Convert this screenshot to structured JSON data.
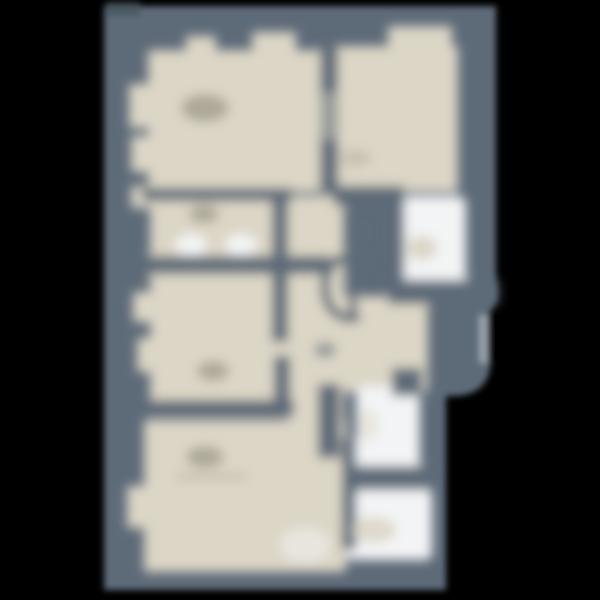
{
  "canvas": {
    "width": 600,
    "height": 600,
    "background": "#000000"
  },
  "palette": {
    "wall": "#5d6b78",
    "wall_dark": "#49565f",
    "floor": "#dcd6c6",
    "white": "#f3f4f5",
    "smudge": "#9d9889",
    "smudge_light": "#b5af9f",
    "edge_light": "#97a1ab",
    "background": "#000000"
  },
  "floorplan": {
    "description": "heavily blurred apartment floor plan, dark slate walls on black background with beige rooms and white bathroom areas",
    "layers": [
      {
        "name": "silhouette",
        "blur": 3.2,
        "shapes": [
          {
            "type": "path",
            "name": "plan-footprint",
            "fill": "wall",
            "d": "M104,6 L496,6 L496,302 L491,310 L491,358 Q491,396 452,396 L446,396 L446,590 L104,590 Z"
          },
          {
            "type": "rect",
            "name": "top-left-wall-shadow",
            "fill": "wall_dark",
            "x": 106,
            "y": 2,
            "w": 34,
            "h": 14,
            "opacity": 0.8
          },
          {
            "type": "rect",
            "name": "balcony-edge-highlight",
            "fill": "edge_light",
            "x": 479,
            "y": 315,
            "w": 9,
            "h": 48
          },
          {
            "type": "rect",
            "name": "balcony-edge-slit",
            "fill": "background",
            "x": 488,
            "y": 312,
            "w": 5,
            "h": 50
          }
        ]
      },
      {
        "name": "interior",
        "blur": 5.5,
        "shapes": [
          {
            "type": "rect",
            "name": "room-top-left-floor",
            "fill": "floor",
            "x": 148,
            "y": 50,
            "w": 174,
            "h": 142
          },
          {
            "type": "rect",
            "name": "window-notch-top-1",
            "fill": "floor",
            "x": 186,
            "y": 36,
            "w": 30,
            "h": 22
          },
          {
            "type": "rect",
            "name": "window-notch-top-2",
            "fill": "floor",
            "x": 252,
            "y": 32,
            "w": 44,
            "h": 26
          },
          {
            "type": "rect",
            "name": "window-notch-left-1",
            "fill": "floor",
            "x": 129,
            "y": 84,
            "w": 24,
            "h": 44
          },
          {
            "type": "rect",
            "name": "window-notch-left-2",
            "fill": "floor",
            "x": 131,
            "y": 136,
            "w": 22,
            "h": 36
          },
          {
            "type": "rect",
            "name": "room-left-2-floor",
            "fill": "floor",
            "x": 150,
            "y": 200,
            "w": 140,
            "h": 60
          },
          {
            "type": "rect",
            "name": "window-notch-left-3",
            "fill": "floor",
            "x": 131,
            "y": 186,
            "w": 20,
            "h": 22
          },
          {
            "type": "rect",
            "name": "room-left-3-floor",
            "fill": "floor",
            "x": 150,
            "y": 274,
            "w": 142,
            "h": 128
          },
          {
            "type": "rect",
            "name": "window-notch-left-4",
            "fill": "floor",
            "x": 133,
            "y": 292,
            "w": 18,
            "h": 30
          },
          {
            "type": "rect",
            "name": "window-notch-left-5",
            "fill": "floor",
            "x": 137,
            "y": 338,
            "w": 16,
            "h": 34
          },
          {
            "type": "rect",
            "name": "room-bottom-left-floor",
            "fill": "floor",
            "x": 144,
            "y": 420,
            "w": 202,
            "h": 152
          },
          {
            "type": "rect",
            "name": "window-notch-left-6",
            "fill": "floor",
            "x": 127,
            "y": 486,
            "w": 18,
            "h": 42
          },
          {
            "type": "rect",
            "name": "corridor-floor",
            "fill": "floor",
            "x": 288,
            "y": 196,
            "w": 56,
            "h": 368
          },
          {
            "type": "rect",
            "name": "room-top-right-floor",
            "fill": "floor",
            "x": 338,
            "y": 46,
            "w": 120,
            "h": 146
          },
          {
            "type": "rect",
            "name": "window-notch-top-right",
            "fill": "floor",
            "x": 388,
            "y": 26,
            "w": 64,
            "h": 24
          },
          {
            "type": "rect",
            "name": "hall-middle-floor",
            "fill": "floor",
            "x": 288,
            "y": 296,
            "w": 140,
            "h": 96
          },
          {
            "type": "rect",
            "name": "bathroom-1-floor",
            "fill": "white",
            "x": 402,
            "y": 196,
            "w": 64,
            "h": 92,
            "rx": 8
          },
          {
            "type": "ellipse",
            "name": "door-swing-1",
            "fill": "white",
            "cx": 191,
            "cy": 245,
            "rxr": 16,
            "ryr": 11
          },
          {
            "type": "ellipse",
            "name": "door-swing-2",
            "fill": "white",
            "cx": 241,
            "cy": 245,
            "rxr": 16,
            "ryr": 11
          },
          {
            "type": "rect",
            "name": "bathroom-2-floor",
            "fill": "white",
            "x": 356,
            "y": 386,
            "w": 64,
            "h": 88,
            "rx": 8
          },
          {
            "type": "rect",
            "name": "bathroom-3-floor",
            "fill": "white",
            "x": 346,
            "y": 488,
            "w": 86,
            "h": 72,
            "rx": 6
          },
          {
            "type": "ellipse",
            "name": "light-patch-room4",
            "fill": "white",
            "cx": 305,
            "cy": 545,
            "rxr": 26,
            "ryr": 18,
            "opacity": 0.5
          },
          {
            "type": "ellipse",
            "name": "light-patch-hall",
            "fill": "white",
            "cx": 445,
            "cy": 272,
            "rxr": 20,
            "ryr": 14,
            "opacity": 0.6
          },
          {
            "type": "rect",
            "name": "wall-room1-room2",
            "fill": "wall",
            "x": 142,
            "y": 188,
            "w": 150,
            "h": 13
          },
          {
            "type": "rect",
            "name": "wall-room2-room3",
            "fill": "wall",
            "x": 131,
            "y": 256,
            "w": 200,
            "h": 18
          },
          {
            "type": "rect",
            "name": "wall-room3-room4",
            "fill": "wall",
            "x": 150,
            "y": 400,
            "w": 144,
            "h": 16
          },
          {
            "type": "rect",
            "name": "wall-corridor-left-upper",
            "fill": "wall",
            "x": 272,
            "y": 194,
            "w": 16,
            "h": 148
          },
          {
            "type": "rect",
            "name": "wall-corridor-left-lower",
            "fill": "wall",
            "x": 274,
            "y": 356,
            "w": 16,
            "h": 60
          },
          {
            "type": "rect",
            "name": "wall-top-middle",
            "fill": "wall",
            "x": 320,
            "y": 44,
            "w": 18,
            "h": 152
          },
          {
            "type": "rect",
            "name": "door-gap-top-middle",
            "fill": "floor",
            "x": 320,
            "y": 92,
            "w": 18,
            "h": 48,
            "opacity": 0.45
          },
          {
            "type": "rect",
            "name": "wall-bathroom1-top",
            "fill": "wall",
            "x": 334,
            "y": 186,
            "w": 70,
            "h": 20
          },
          {
            "type": "rect",
            "name": "wall-bathroom1-left",
            "fill": "wall",
            "x": 386,
            "y": 196,
            "w": 18,
            "h": 92
          },
          {
            "type": "rect",
            "name": "wall-below-bathroom1",
            "fill": "wall",
            "x": 388,
            "y": 280,
            "w": 110,
            "h": 24
          },
          {
            "type": "rect",
            "name": "wall-above-bathroom2",
            "fill": "wall",
            "x": 392,
            "y": 368,
            "w": 30,
            "h": 28
          },
          {
            "type": "rect",
            "name": "wall-hall-middle",
            "fill": "wall",
            "x": 318,
            "y": 384,
            "w": 22,
            "h": 74
          },
          {
            "type": "rect",
            "name": "wall-bathrooms-left",
            "fill": "wall",
            "x": 342,
            "y": 438,
            "w": 14,
            "h": 112
          },
          {
            "type": "rect",
            "name": "wall-bathroom2-bathroom3",
            "fill": "wall",
            "x": 344,
            "y": 466,
            "w": 86,
            "h": 24
          },
          {
            "type": "path",
            "name": "stair-spiral-symbol",
            "stroke": "wall",
            "strokeWidth": 9,
            "fill": "none",
            "d": "M380,262 C350,250 326,258 325,284 C324,308 338,320 356,318"
          },
          {
            "type": "path",
            "name": "stair-spiral-riser",
            "stroke": "wall",
            "strokeWidth": 8,
            "fill": "none",
            "d": "M353,270 L353,318"
          },
          {
            "type": "path",
            "name": "stair-spiral-link",
            "stroke": "wall",
            "strokeWidth": 8,
            "fill": "none",
            "d": "M380,262 L395,269",
            "opacity": 0.8
          },
          {
            "type": "ellipse",
            "name": "room1-label-smudge",
            "fill": "smudge",
            "cx": 205,
            "cy": 108,
            "rxr": 24,
            "ryr": 14,
            "opacity": 0.75
          },
          {
            "type": "ellipse",
            "name": "room2-label-smudge",
            "fill": "smudge",
            "cx": 204,
            "cy": 214,
            "rxr": 15,
            "ryr": 9,
            "opacity": 0.75
          },
          {
            "type": "ellipse",
            "name": "room3-label-smudge",
            "fill": "smudge",
            "cx": 213,
            "cy": 371,
            "rxr": 16,
            "ryr": 10,
            "opacity": 0.75
          },
          {
            "type": "ellipse",
            "name": "room4-label-smudge",
            "fill": "smudge",
            "cx": 205,
            "cy": 457,
            "rxr": 19,
            "ryr": 11,
            "opacity": 0.75
          },
          {
            "type": "ellipse",
            "name": "room-right-label-smudge",
            "fill": "smudge",
            "cx": 356,
            "cy": 158,
            "rxr": 15,
            "ryr": 8,
            "opacity": 0.35
          },
          {
            "type": "ellipse",
            "name": "hall-label-smudge",
            "fill": "wall",
            "cx": 325,
            "cy": 350,
            "rxr": 11,
            "ryr": 8,
            "opacity": 0.55
          },
          {
            "type": "rect",
            "name": "room4-underline-smudge",
            "fill": "smudge_light",
            "x": 176,
            "y": 474,
            "w": 70,
            "h": 5,
            "opacity": 0.8
          },
          {
            "type": "ellipse",
            "name": "bathroom1-fixture",
            "fill": "floor",
            "cx": 422,
            "cy": 248,
            "rxr": 15,
            "ryr": 12
          },
          {
            "type": "ellipse",
            "name": "bathroom3-fixture",
            "fill": "floor",
            "cx": 374,
            "cy": 530,
            "rxr": 22,
            "ryr": 13,
            "opacity": 0.9
          },
          {
            "type": "ellipse",
            "name": "bathroom2-fixture",
            "fill": "floor",
            "cx": 368,
            "cy": 425,
            "rxr": 10,
            "ryr": 16,
            "opacity": 0.5
          }
        ]
      }
    ]
  }
}
